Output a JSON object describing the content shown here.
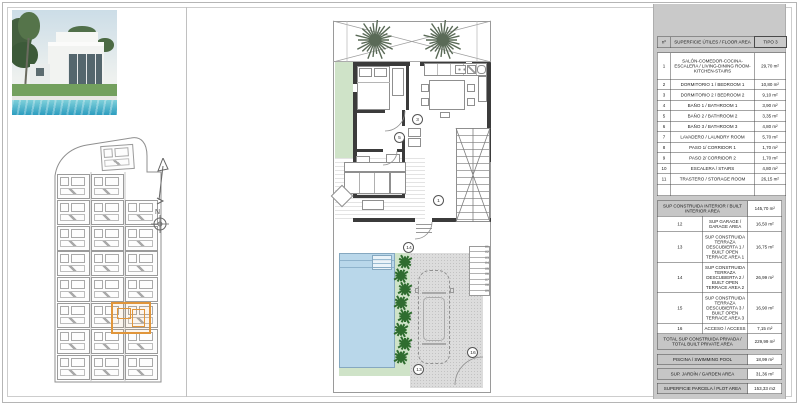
{
  "colors": {
    "pool": "#b9d7ea",
    "garden": "#cfe3c8",
    "plant": "#2f6d2f",
    "palm": "#5a6a57",
    "wall": "#3b3b3b",
    "driveway": "#dcdcdc",
    "highlight": "#e0953a",
    "panel": "#c9c9c9"
  },
  "site_plan": {
    "north_label": "N"
  },
  "floor_plan": {
    "markers": [
      "1",
      "3",
      "5",
      "13",
      "14",
      "16"
    ],
    "step_numbers": [
      "01",
      "02",
      "03",
      "04",
      "05",
      "06",
      "07",
      "08",
      "09"
    ]
  },
  "area_table": {
    "headers": {
      "no": "nº",
      "description": "SUPERFICIE ÚTILES / FLOOR AREA",
      "type": "TIPO 3"
    },
    "useful_rows": [
      {
        "no": "1",
        "label": "SALÓN-COMEDOR-COCINA-ESCALERA / LIVING-DINING ROOM-KITCHEN-STAIRS",
        "value": "29,70 m²"
      },
      {
        "no": "2",
        "label": "DORMITORIO 1 / BEDROOM 1",
        "value": "10,80 m²"
      },
      {
        "no": "3",
        "label": "DORMITORIO 2 / BEDROOM 2",
        "value": "9,10 m²"
      },
      {
        "no": "4",
        "label": "BAÑO 1 / BATHROOM 1",
        "value": "3,90 m²"
      },
      {
        "no": "5",
        "label": "BAÑO 2 / BATHROOM 2",
        "value": "3,35 m²"
      },
      {
        "no": "6",
        "label": "BAÑO 3 / BATHROOM 3",
        "value": "4,80 m²"
      },
      {
        "no": "7",
        "label": "LAVADERO / LAUNDRY ROOM",
        "value": "5,70 m²"
      },
      {
        "no": "8",
        "label": "PASO 1/ CORRIDOR 1",
        "value": "1,70 m²"
      },
      {
        "no": "9",
        "label": "PASO 2/ CORRIDOR 2",
        "value": "1,70 m²"
      },
      {
        "no": "10",
        "label": "ESCALERA / STAIRS",
        "value": "4,80 m²"
      },
      {
        "no": "11",
        "label": "TRASTERO / STORAGE ROOM",
        "value": "26,15 m²"
      }
    ],
    "built_section": {
      "interior": {
        "label": "SUP CONSTRUIDA INTERIOR / BUILT INTERIOR AREA",
        "value": "145,70 m²"
      },
      "rows": [
        {
          "no": "12",
          "label": "SUP GARAGE / GARAGE AREA",
          "value": "16,50 m²"
        },
        {
          "no": "13",
          "label": "SUP CONSTRUIDA TERRAZA DESCUBIERTA 1 / BUILT OPEN TERRACE AREA 1",
          "value": "16,75 m²"
        },
        {
          "no": "14",
          "label": "SUP CONSTRUIDA TERRAZA DESCUBIERTA 2 / BUILT OPEN TERRACE AREA 2",
          "value": "26,99 m²"
        },
        {
          "no": "15",
          "label": "SUP CONSTRUIDA TERRAZA DESCUBIERTA 3 / BUILT OPEN TERRACE AREA 3",
          "value": "16,90 m²"
        },
        {
          "no": "16",
          "label": "ACCESO / ACCESS",
          "value": "7,15 m²"
        }
      ],
      "total": {
        "label": "TOTAL SUP CONSTRUIDA PRIVADA / TOTAL BUILT PRIVATE AREA",
        "value": "229,99 m²"
      }
    },
    "summary_rows": [
      {
        "label": "PISCINA / SWIMMING POOL",
        "value": "18,99 m²"
      },
      {
        "label": "SUP. JARDÍN / GARDEN AREA",
        "value": "31,36 m²"
      },
      {
        "label": "SUPERFICIE PARCELA / PLOT AREA",
        "value": "153,33 m2"
      }
    ]
  }
}
